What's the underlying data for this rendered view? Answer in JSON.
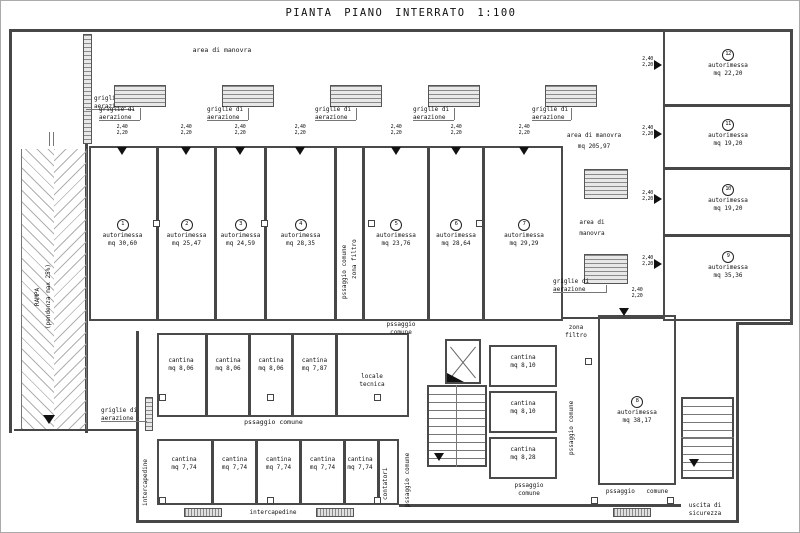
{
  "title": "PIANTA PIANO INTERRATO 1:100",
  "labels": {
    "rampa": "RAMPA",
    "pendenza": "(pendenza max 25%)",
    "area_manovra": "area di manovra",
    "area_manovra_mq": "mq 205,97",
    "area_di": "area di",
    "manovra": "manovra",
    "griglie_1": "griglie di",
    "griglie_2": "aerazione",
    "passaggio_comune": "pssaggio comune",
    "passaggio": "pssaggio",
    "comune": "comune",
    "zona": "zona",
    "filtro": "filtro",
    "zona_filtro": "zona filtro",
    "locale": "locale",
    "tecnica": "tecnica",
    "contatori": "contatori",
    "intercapedine": "intercapedine",
    "uscita_di": "uscita di",
    "sicurezza": "sicurezza",
    "dim_w": "2,40",
    "dim_h": "2,20"
  },
  "garages": [
    {
      "num": "1",
      "name": "autorimessa",
      "mq": "mq 30,60"
    },
    {
      "num": "2",
      "name": "autorimessa",
      "mq": "mq 25,47"
    },
    {
      "num": "3",
      "name": "autorimessa",
      "mq": "mq 24,59"
    },
    {
      "num": "4",
      "name": "autorimessa",
      "mq": "mq 28,35"
    },
    {
      "num": "5",
      "name": "autorimessa",
      "mq": "mq 23,76"
    },
    {
      "num": "6",
      "name": "autorimessa",
      "mq": "mq 28,64"
    },
    {
      "num": "7",
      "name": "autorimessa",
      "mq": "mq 29,29"
    },
    {
      "num": "8",
      "name": "autorimessa",
      "mq": "mq 38,17"
    },
    {
      "num": "9",
      "name": "autorimessa",
      "mq": "mq 35,36"
    },
    {
      "num": "10",
      "name": "autorimessa",
      "mq": "mq 19,20"
    },
    {
      "num": "11",
      "name": "autorimessa",
      "mq": "mq 19,20"
    },
    {
      "num": "12",
      "name": "autorimessa",
      "mq": "mq 22,20"
    }
  ],
  "cantine_sup": [
    {
      "name": "cantina",
      "mq": "mq 8,06"
    },
    {
      "name": "cantina",
      "mq": "mq 8,06"
    },
    {
      "name": "cantina",
      "mq": "mq 8,06"
    },
    {
      "name": "cantina",
      "mq": "mq 7,87"
    }
  ],
  "cantine_inf": [
    {
      "name": "cantina",
      "mq": "mq 7,74"
    },
    {
      "name": "cantina",
      "mq": "mq 7,74"
    },
    {
      "name": "cantina",
      "mq": "mq 7,74"
    },
    {
      "name": "cantina",
      "mq": "mq 7,74"
    },
    {
      "name": "cantina",
      "mq": "mq 7,74"
    }
  ],
  "cantine_dx": [
    {
      "name": "cantina",
      "mq": "mq 8,10"
    },
    {
      "name": "cantina",
      "mq": "mq 8,10"
    },
    {
      "name": "cantina",
      "mq": "mq 8,28"
    }
  ]
}
